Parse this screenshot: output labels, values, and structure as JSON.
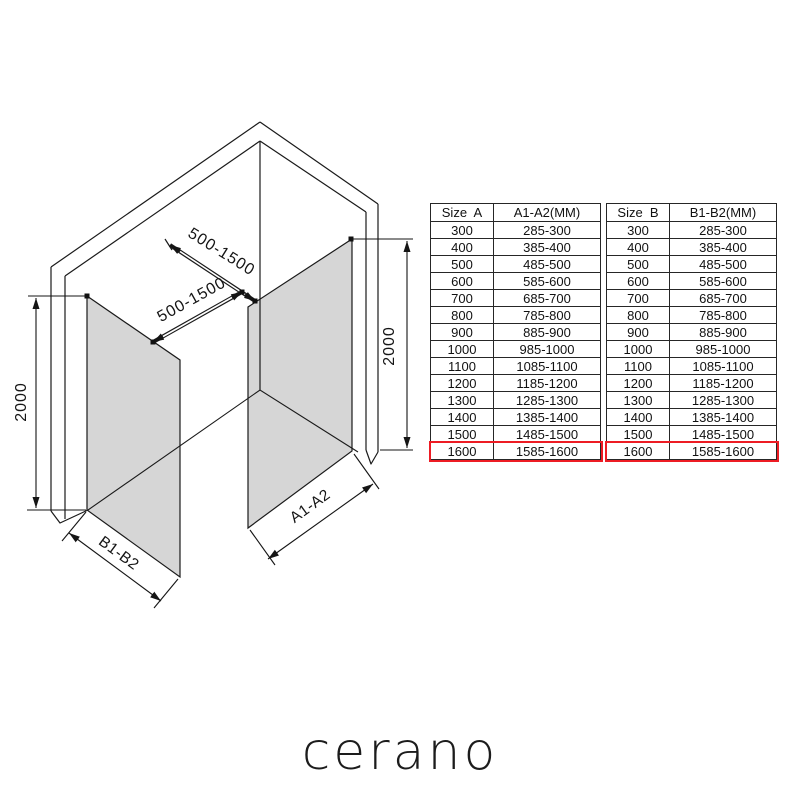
{
  "diagram": {
    "dim_labels": {
      "height_left": "2000",
      "height_right": "2000",
      "bar_top": "500-1500",
      "bar_bottom": "500-1500",
      "panel_b_width": "B1-B2",
      "panel_a_width": "A1-A2"
    },
    "glass_color": "#d6d6d6",
    "line_color": "#1a1a1a"
  },
  "tables": [
    {
      "id": "size-a",
      "headers": [
        "Size  A",
        "A1-A2(MM)"
      ],
      "rows": [
        [
          "300",
          "285-300"
        ],
        [
          "400",
          "385-400"
        ],
        [
          "500",
          "485-500"
        ],
        [
          "600",
          "585-600"
        ],
        [
          "700",
          "685-700"
        ],
        [
          "800",
          "785-800"
        ],
        [
          "900",
          "885-900"
        ],
        [
          "1000",
          "985-1000"
        ],
        [
          "1100",
          "1085-1100"
        ],
        [
          "1200",
          "1185-1200"
        ],
        [
          "1300",
          "1285-1300"
        ],
        [
          "1400",
          "1385-1400"
        ],
        [
          "1500",
          "1485-1500"
        ],
        [
          "1600",
          "1585-1600"
        ]
      ],
      "highlight_row": "1600",
      "highlight_color": "#ed1c24"
    },
    {
      "id": "size-b",
      "headers": [
        "Size  B",
        "B1-B2(MM)"
      ],
      "rows": [
        [
          "300",
          "285-300"
        ],
        [
          "400",
          "385-400"
        ],
        [
          "500",
          "485-500"
        ],
        [
          "600",
          "585-600"
        ],
        [
          "700",
          "685-700"
        ],
        [
          "800",
          "785-800"
        ],
        [
          "900",
          "885-900"
        ],
        [
          "1000",
          "985-1000"
        ],
        [
          "1100",
          "1085-1100"
        ],
        [
          "1200",
          "1185-1200"
        ],
        [
          "1300",
          "1285-1300"
        ],
        [
          "1400",
          "1385-1400"
        ],
        [
          "1500",
          "1485-1500"
        ],
        [
          "1600",
          "1585-1600"
        ]
      ],
      "highlight_row": "1600",
      "highlight_color": "#ed1c24"
    }
  ],
  "logo": "cerano"
}
